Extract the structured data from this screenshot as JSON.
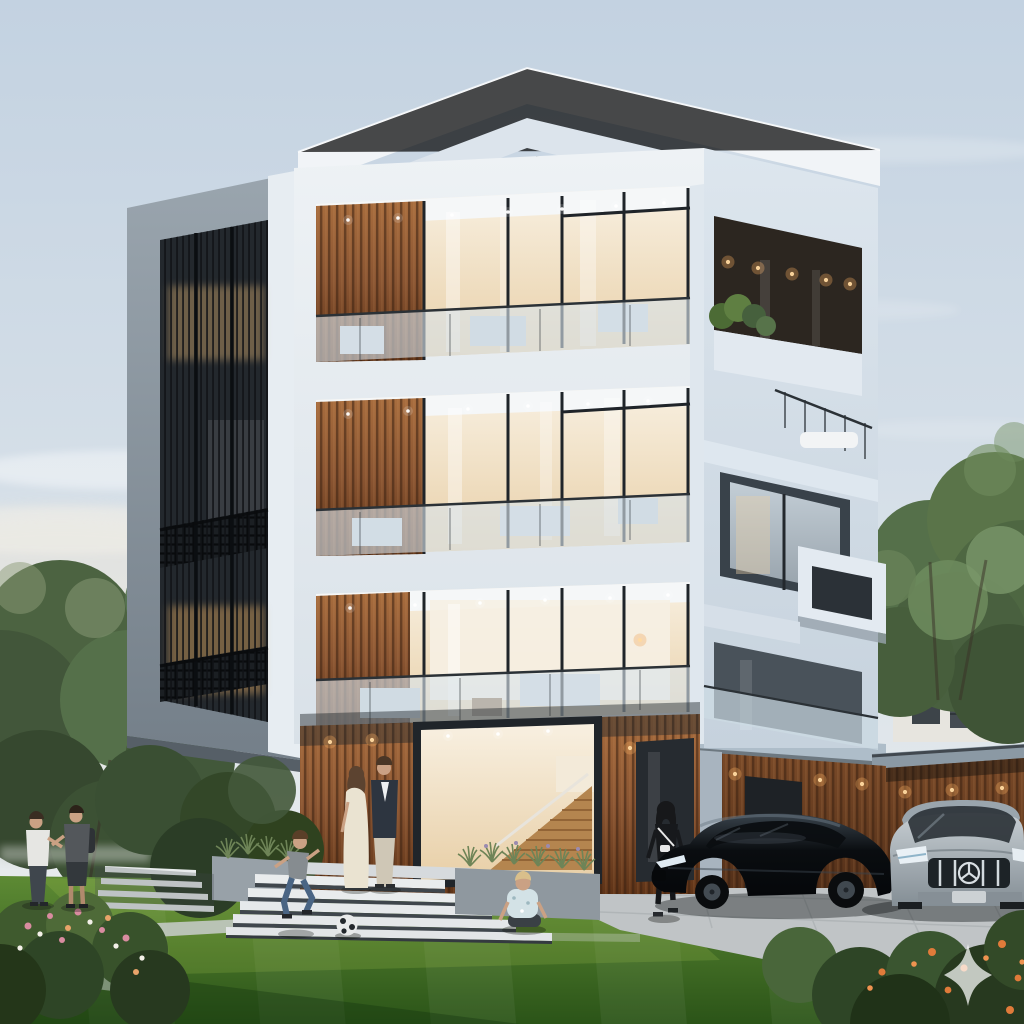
{
  "scene": {
    "title": "Modern four-storey residence at dusk — architectural rendering",
    "description": "White cubic four-storey house with wood-slat accents, corner glass balconies, a dark louvered side facade, front lawn with a family, wide entry steps, planters, and two luxury cars parked beside a wood-clad garage at dusk.",
    "time_of_day": "dusk",
    "objects": [
      "sky",
      "clouds",
      "trees-left",
      "trees-right",
      "neighbor-house",
      "lawn",
      "walkway",
      "driveway",
      "garage",
      "building",
      "entry-steps",
      "planters",
      "flower-beds",
      "people",
      "cars",
      "soccer-ball",
      "watermark-sparkle"
    ]
  },
  "building": {
    "storeys": 4,
    "features": [
      "white-render-frames",
      "corner-glass-balconies",
      "glass-balustrades",
      "vertical-wood-slats",
      "dark-metal-louver-screen",
      "recessed-downlights",
      "cantilevered-volumes",
      "roof-terrace-railing",
      "planter-terrace",
      "floating-white-box",
      "glazed-entry-with-stair"
    ]
  },
  "people": [
    {
      "label": "man-white-tshirt",
      "position": "far-left-lawn"
    },
    {
      "label": "man-gray-tshirt-backpack",
      "position": "far-left-lawn"
    },
    {
      "label": "woman-cream-dress",
      "position": "entry-steps"
    },
    {
      "label": "man-dark-blazer",
      "position": "entry-steps"
    },
    {
      "label": "boy-running",
      "position": "lawn-center"
    },
    {
      "label": "child-sitting",
      "position": "lawn-center-right"
    },
    {
      "label": "woman-black-outfit-walking",
      "position": "driveway-left"
    }
  ],
  "vehicles": [
    {
      "label": "black-sport-sedan",
      "position": "driveway-center"
    },
    {
      "label": "silver-luxury-car-three-pointed-star",
      "position": "driveway-right"
    }
  ],
  "landscape": {
    "lawn": "striped green lawn with sunlit band and foreground shadow",
    "flower_beds": [
      "pink-white flowers bottom-left",
      "orange flowers bottom-right"
    ],
    "trees": "deciduous trees flanking both sides",
    "walkway": "light stone path across lawn to steps"
  },
  "neighborhood": {
    "house": "white gabled house with dark roof behind trees at right"
  },
  "watermark": {
    "icon": "four-point-sparkle",
    "position": "bottom-right",
    "opacity": 0.72
  },
  "colors": {
    "sky_top": "#c3d2e1",
    "sky_mid": "#d8e1e9",
    "sky_horizon": "#edefee",
    "warm_haze": "#f2e8d7",
    "roof_slab": "#f1f4f7",
    "fascia_blue": "#dce4ec",
    "facade_white": "#eef2f5",
    "facade_shade": "#d9e1e8",
    "facade_right_top": "#dde6ee",
    "facade_right_bottom": "#c6d2dd",
    "frame_light": "#9aa5ae",
    "frame_dark": "#747f89",
    "window_dark": "#23282d",
    "louver": "#0f1215",
    "wood_light": "#a86d3e",
    "wood_mid": "#8a5532",
    "wood_dark": "#5e3317",
    "wing_wood_top": "#7a4a28",
    "wing_wood_bottom": "#543019",
    "interior_light": "#f8f0e1",
    "interior_warm": "#e8cfa7",
    "glow_amber": "#f0a95f",
    "balustrade_glass": "#d8e4ec",
    "rail_dark": "#2b3136",
    "glass_cool": "#aeb9c2",
    "driveway": "#c0c4c6",
    "steps_white": "#e9eced",
    "steps_shadow": "#3f464c",
    "planter_gray": "#98a1a8",
    "lawn_top": "#5d8a34",
    "lawn_bottom": "#2b5418",
    "lawn_lit": "#9ebf4e",
    "tree_dark": "#42563a",
    "tree_mid": "#55704a",
    "tree_light": "#6f8c5e",
    "bush_dark": "#2e4526",
    "flower_pink": "#d98ca0",
    "flower_orange": "#e07b3a",
    "neighbor_wall": "#e7e5df",
    "neighbor_roof": "#4a5157",
    "car_black": "#0a0d10",
    "car_black_hi": "#39434c",
    "car_silver_light": "#c6cdd2",
    "car_silver_dark": "#848e95",
    "chrome": "#d3dade",
    "skin": "#caa184",
    "tee_white": "#e6e6e3",
    "tee_gray": "#53575b",
    "dress_cream": "#eae3d1",
    "blazer_navy": "#2d3540",
    "pants_beige": "#cfc7b6",
    "jeans_blue": "#4a6584",
    "boy_tee": "#868c90",
    "child_shirt": "#d3e2e6",
    "outfit_black": "#17191c",
    "hair_brown": "#5c4330",
    "hair_blond": "#d9bf8b",
    "watermark_white": "#ffffff"
  }
}
